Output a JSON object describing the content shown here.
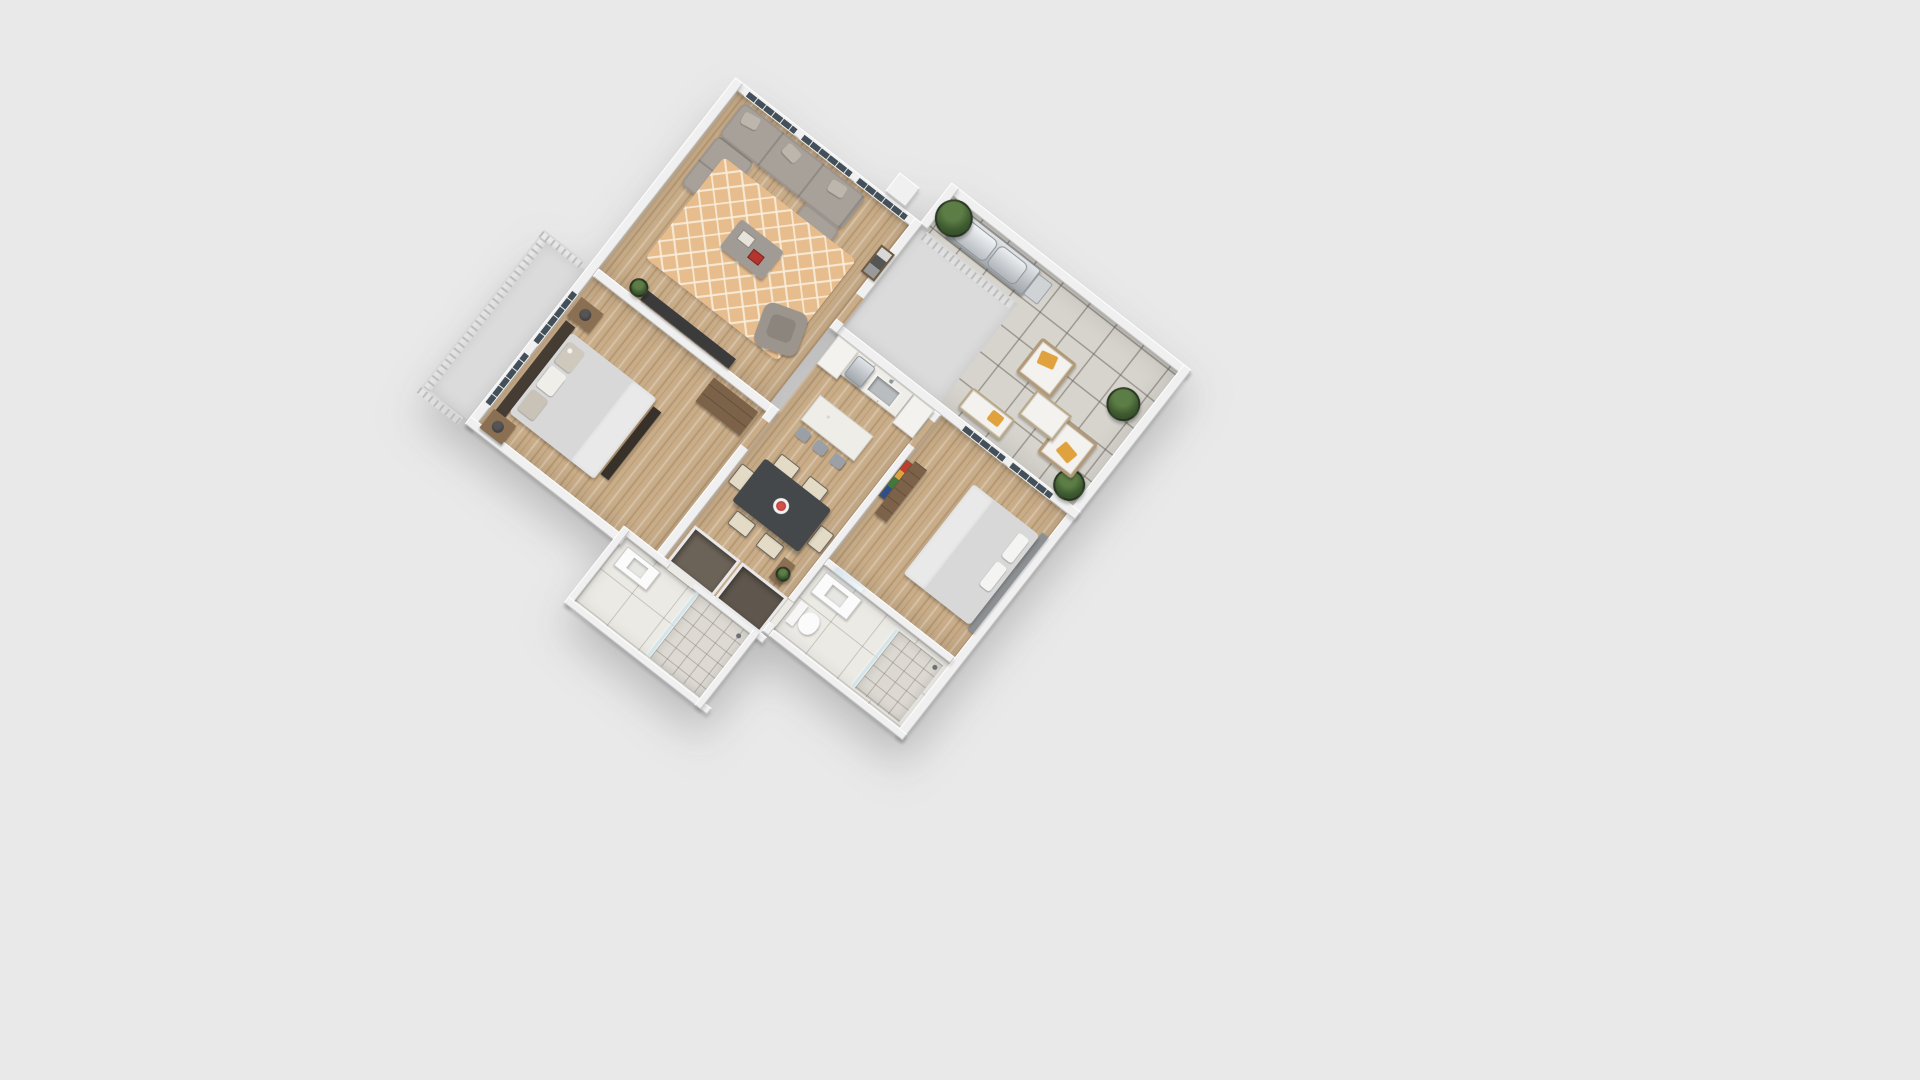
{
  "scene": {
    "kind": "3d-floor-plan-render",
    "description": "Isometric 3D rendering of a two-bedroom apartment floor plan on a plain light gray background, rotated diagonally",
    "background_color": "#e9e9e9",
    "plan_rotation_deg": 38,
    "has_text": false
  },
  "palette": {
    "background": "#e9e9e9",
    "walls": "#f0f0f0",
    "wood_floor": "#c9ad89",
    "patio_tile": "#d7d4ce",
    "marble_floor": "#eceae5",
    "rug": "#e8bd8d",
    "sofa_gray": "#a8a19a",
    "dining_table": "#45484a",
    "accent_orange_pillow": "#e0a23f",
    "flower_red": "#b5342e",
    "plant_green": "#3d5a30",
    "wood_furniture": "#7b6248",
    "stainless": "#aab0b5"
  },
  "rooms": [
    {
      "id": "patio",
      "name": "patio-terrace",
      "floor": "tile",
      "furniture": [
        "bbq-grill",
        "potted-plant",
        "potted-plant",
        "potted-plant",
        "lounge-chair",
        "lounge-chair",
        "outdoor-coffee-table",
        "outdoor-bench"
      ]
    },
    {
      "id": "living-room",
      "name": "living-room",
      "floor": "wood",
      "furniture": [
        "sectional-sofa",
        "area-rug",
        "coffee-table",
        "swivel-armchair",
        "tv-console",
        "framed-art-bw",
        "small-plant"
      ],
      "features": [
        "floor-to-ceiling-windows"
      ]
    },
    {
      "id": "kitchen",
      "name": "kitchen",
      "floor": "wood",
      "furniture": [
        "counter-with-sink",
        "dishwasher",
        "tall-cabinet",
        "tall-cabinet",
        "island",
        "bar-stool",
        "bar-stool",
        "bar-stool"
      ]
    },
    {
      "id": "dining-area",
      "name": "dining-area",
      "floor": "wood",
      "furniture": [
        "dining-table",
        "dining-chair",
        "dining-chair",
        "dining-chair",
        "dining-chair",
        "dining-chair",
        "dining-chair",
        "flower-centerpiece"
      ]
    },
    {
      "id": "bedroom-2",
      "name": "bedroom-2",
      "floor": "wood",
      "furniture": [
        "bed",
        "pillows",
        "media-console",
        "framed-art-color"
      ],
      "features": [
        "windows-to-patio"
      ]
    },
    {
      "id": "bathroom-1",
      "name": "bathroom-1",
      "floor": "marble",
      "furniture": [
        "vanity-with-mirror",
        "toilet",
        "shower"
      ]
    },
    {
      "id": "master-bedroom",
      "name": "master-bedroom",
      "floor": "wood",
      "furniture": [
        "bed",
        "dark-headboard",
        "foot-bench",
        "nightstand-with-lamp",
        "nightstand-with-lamp",
        "dresser"
      ],
      "features": [
        "windows-to-balcony"
      ]
    },
    {
      "id": "hallway",
      "name": "hallway-closets",
      "floor": "wood",
      "furniture": [
        "closet",
        "closet",
        "console-with-plant"
      ]
    },
    {
      "id": "bathroom-2",
      "name": "bathroom-2",
      "floor": "marble",
      "furniture": [
        "walk-in-shower",
        "vanity"
      ]
    },
    {
      "id": "balcony",
      "name": "master-balcony",
      "floor": "concrete",
      "features": [
        "railing"
      ]
    },
    {
      "id": "porch",
      "name": "entry-porch",
      "floor": "concrete",
      "features": [
        "railing"
      ]
    }
  ],
  "counts": {
    "bedrooms": 2,
    "bathrooms": 2,
    "patio_lounge_chairs": 2,
    "dining_chairs": 6,
    "bar_stools": 3,
    "potted_plants": 3
  }
}
